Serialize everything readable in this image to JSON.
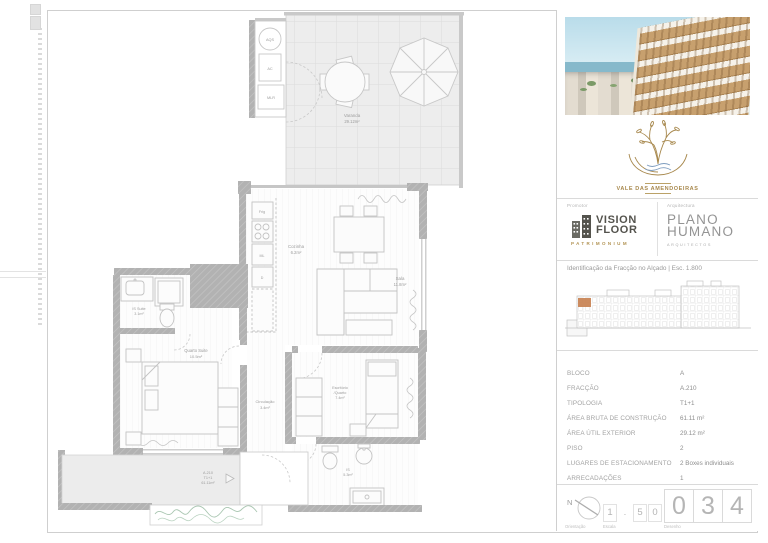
{
  "title_block": {
    "brand": {
      "name": "VALE DAS AMENDOEIRAS"
    },
    "promotor": {
      "label": "Promotor",
      "line1": "VISION",
      "line2": "FLOOR",
      "sub": "PATRIMONIUM"
    },
    "arquitectura": {
      "label": "Arquitectura",
      "line1": "PLANO",
      "line2": "HUMANO",
      "sub": "ARQUITECTOS"
    },
    "caption": "Identificação da Fracção no Alçado | Esc. 1.800",
    "table": {
      "rows": [
        {
          "label": "BLOCO",
          "value": "A"
        },
        {
          "label": "FRACÇÃO",
          "value": "A.210"
        },
        {
          "label": "TIPOLOGIA",
          "value": "T1+1"
        },
        {
          "label": "ÁREA BRUTA DE CONSTRUÇÃO",
          "value": "61.11 m²"
        },
        {
          "label": "ÁREA ÚTIL EXTERIOR",
          "value": "29.12 m²"
        },
        {
          "label": "PISO",
          "value": "2"
        },
        {
          "label": "LUGARES DE ESTACIONAMENTO",
          "value": "2 Boxes individuais"
        },
        {
          "label": "ARRECADAÇÕES",
          "value": "1"
        }
      ]
    },
    "footer": {
      "orientation_label": "Orientação",
      "north": "N",
      "scale_label": "Escala",
      "scale_digits": [
        "1",
        ".",
        "5",
        "0"
      ],
      "drawing_label": "Desenho",
      "drawing_digits": [
        "0",
        "3",
        "4"
      ]
    }
  },
  "plan": {
    "varanda": {
      "name": "Varanda",
      "area": "29.12m²"
    },
    "cozinha": {
      "name": "Cozinha",
      "area": "6.2m²"
    },
    "sala": {
      "name": "Sala",
      "area": "11.8m²"
    },
    "is_suite": {
      "name": "IS Suite",
      "area": "3.1m²"
    },
    "quarto_suite": {
      "name": "Quarto Suite",
      "area": "10.5m²"
    },
    "circulacao": {
      "name": "Circulação",
      "area": "3.4m²"
    },
    "escritorio": {
      "name": "Escritório",
      "name2": "/Quarto",
      "area": "7.4m²"
    },
    "is": {
      "name": "IS",
      "area": "5.3m²"
    },
    "unit_tag": {
      "code": "A.210",
      "type": "T1+1",
      "area": "61.11m²"
    },
    "tech": {
      "aqs": "AQS",
      "ac": "AC",
      "mlr": "MLR"
    },
    "kitchen": {
      "frig": "Frig",
      "ml": "ML",
      "d": "D"
    }
  }
}
